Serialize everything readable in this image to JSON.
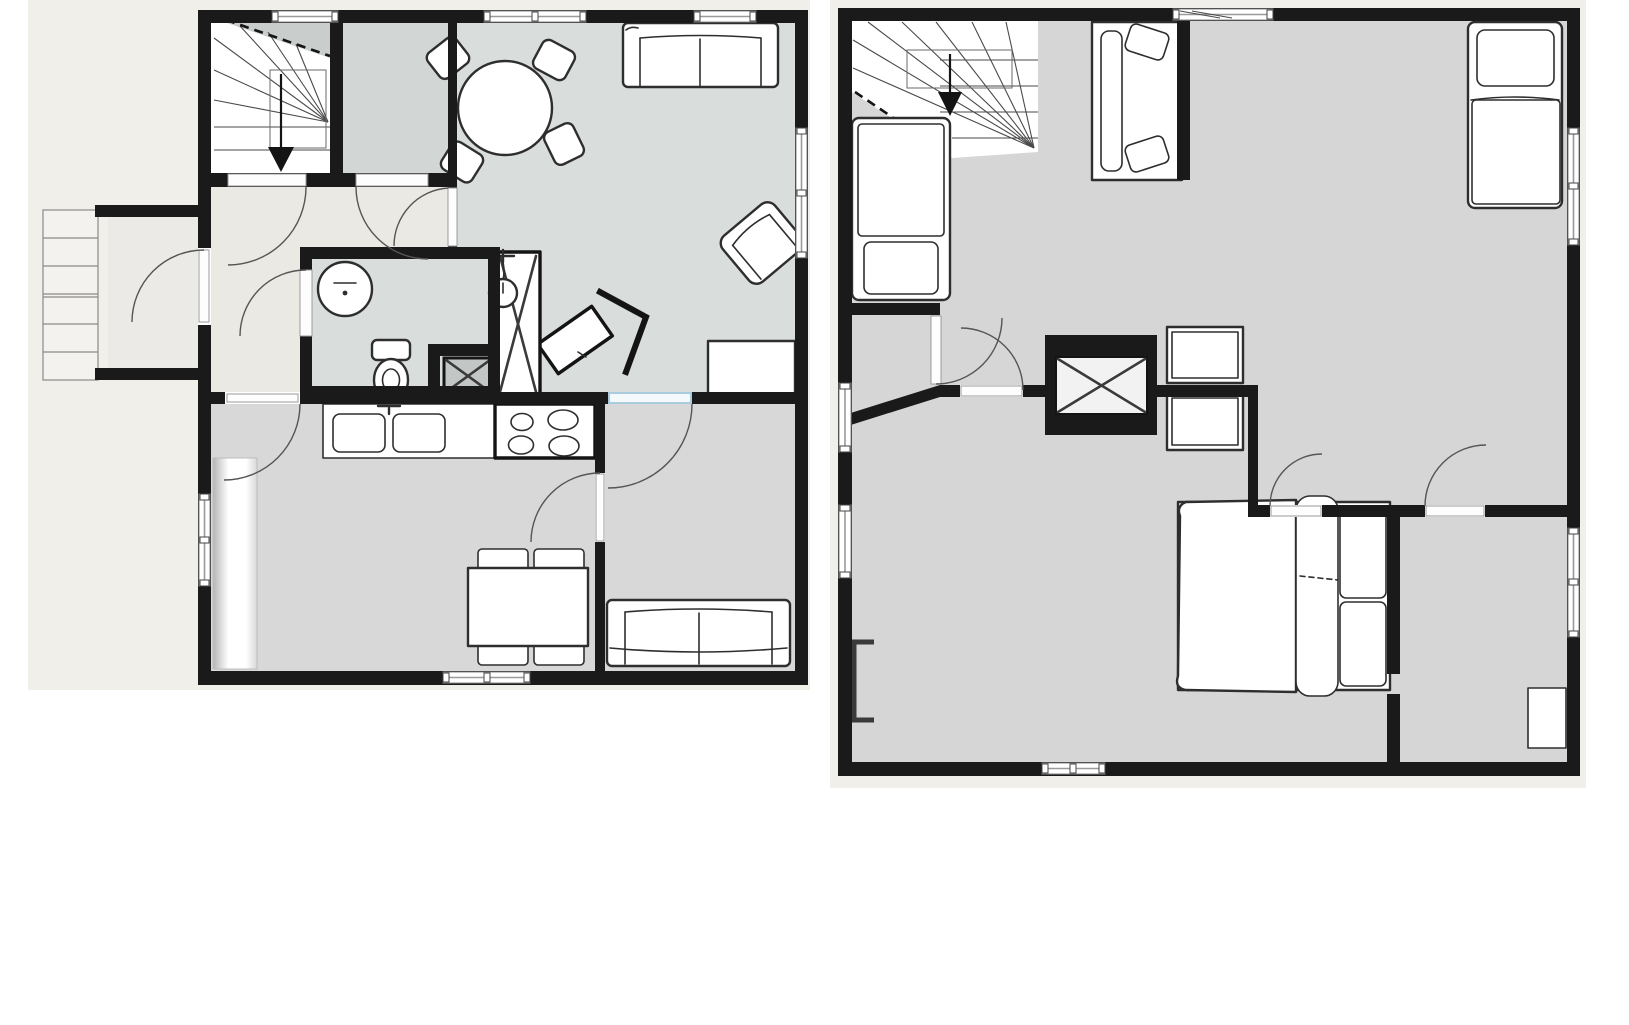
{
  "meta": {
    "description": "Two black-and-white architectural floor plans shown side by side on a white page: left plan is a ground floor, right plan is an upper floor. No text labels are rendered in the image.",
    "plan_count": 2
  },
  "colors": {
    "wall": "#1a1a1a",
    "plan_bg": "#f0efea",
    "floor_gray": "#d6d6d6",
    "floor_living": "#d9dddb",
    "floor_hall": "#ebe9e4",
    "floor_closet": "#d2d6d4",
    "floor_kitchen": "#d8d8d8",
    "floor_porch": "#eceae6",
    "stair_cut_gray": "#c9cecc",
    "furniture_fill": "#ffffff",
    "furniture_stroke": "#2e2e2e",
    "door_arc": "#555555",
    "door_accent_blue": "#aacbdd",
    "washer_fill": "#c2c6c4",
    "steps_fill": "#f3f2ef"
  },
  "plans": [
    {
      "id": "ground-floor",
      "position": "left",
      "rooms": [
        {
          "name": "staircase-room",
          "features": [
            "winder-staircase",
            "down-arrow"
          ]
        },
        {
          "name": "closet-room",
          "features": []
        },
        {
          "name": "hallway",
          "features": [
            "door-to-stairs",
            "door-to-closet",
            "door-to-living-room",
            "door-to-bathroom",
            "door-to-kitchen",
            "door-to-porch"
          ]
        },
        {
          "name": "bathroom",
          "features": [
            "washbasin",
            "toilet",
            "shower-fixture",
            "washing-machine"
          ]
        },
        {
          "name": "living-room",
          "features": [
            "round-table-with-4-chairs",
            "sofa",
            "armchair",
            "tv-on-angled-stand",
            "wardrobe-with-x",
            "sideboard-bench",
            "window-top",
            "window-right"
          ]
        },
        {
          "name": "kitchen-dining-room",
          "features": [
            "double-sink-counter",
            "stove-4-burners",
            "tall-counter",
            "dining-table-with-4-chairs",
            "window-left",
            "window-bottom"
          ]
        },
        {
          "name": "second-lounge-room",
          "features": [
            "sofa",
            "blue-accent-door"
          ]
        },
        {
          "name": "entry-porch",
          "features": [
            "exterior-steps",
            "entry-door"
          ]
        }
      ],
      "window_count": 7,
      "door_count": 8
    },
    {
      "id": "upper-floor",
      "position": "right",
      "rooms": [
        {
          "name": "bedroom-top-left",
          "features": [
            "winder-staircase",
            "down-arrow",
            "single-bed-left",
            "single-bed-top-center"
          ]
        },
        {
          "name": "bedroom-top-right",
          "features": [
            "single-bed",
            "dresser-top",
            "dresser-bottom",
            "window-top",
            "window-right"
          ]
        },
        {
          "name": "landing-hall",
          "features": [
            "door-to-bedroom-top-left",
            "door-to-master-bedroom",
            "window-left",
            "angled-wall"
          ]
        },
        {
          "name": "master-bedroom",
          "features": [
            "double-bed-with-pillows",
            "wall-closet-with-x",
            "desk-bracket",
            "window-left",
            "window-bottom"
          ]
        },
        {
          "name": "bedroom-bottom-right",
          "features": [
            "desk",
            "door-top",
            "window-right"
          ]
        }
      ],
      "window_count": 6,
      "door_count": 4
    }
  ]
}
